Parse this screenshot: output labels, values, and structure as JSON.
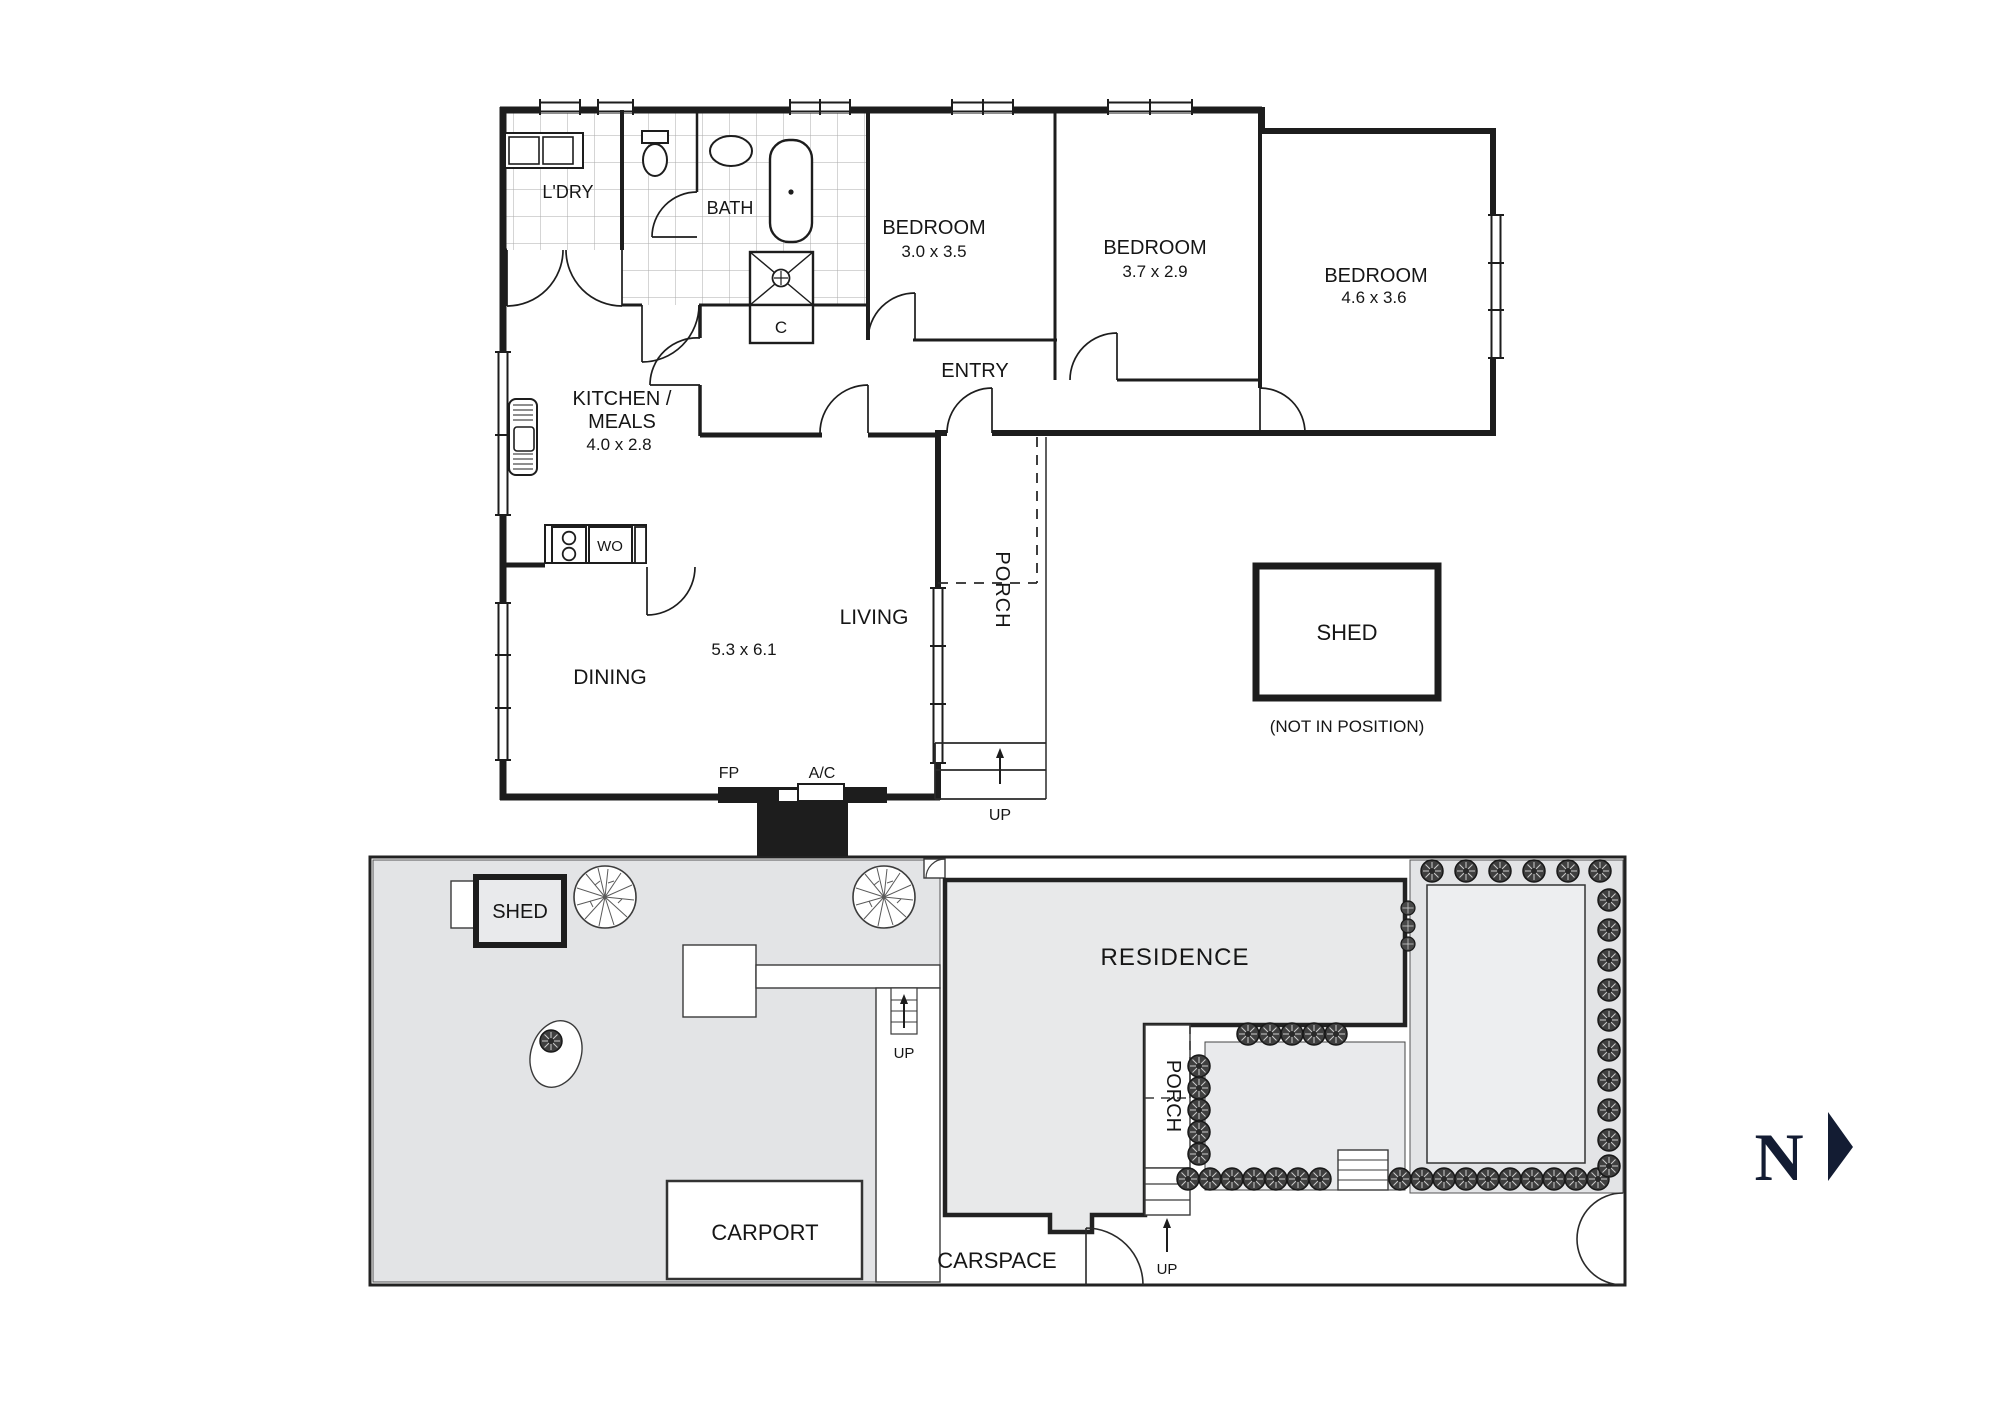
{
  "floor_plan": {
    "rooms": {
      "laundry": {
        "label": "L'DRY"
      },
      "bath": {
        "label": "BATH"
      },
      "bedroom1": {
        "label": "BEDROOM",
        "dims": "3.0 x 3.5"
      },
      "bedroom2": {
        "label": "BEDROOM",
        "dims": "3.7 x 2.9"
      },
      "bedroom3": {
        "label": "BEDROOM",
        "dims": "4.6 x 3.6"
      },
      "entry": {
        "label": "ENTRY"
      },
      "kitchen": {
        "label_line1": "KITCHEN /",
        "label_line2": "MEALS",
        "dims": "4.0 x 2.8"
      },
      "living": {
        "label": "LIVING",
        "dims": "5.3 x 6.1"
      },
      "dining": {
        "label": "DINING"
      },
      "porch": {
        "label": "PORCH"
      },
      "closet": {
        "label": "C"
      }
    },
    "fixtures": {
      "wall_oven": "WO",
      "fireplace": "FP",
      "air_conditioner": "A/C",
      "up": "UP"
    },
    "shed": {
      "label": "SHED",
      "note": "(NOT IN POSITION)"
    }
  },
  "site_plan": {
    "residence_label": "RESIDENCE",
    "porch_label": "PORCH",
    "carport_label": "CARPORT",
    "carspace_label": "CARSPACE",
    "shed_label": "SHED",
    "up_label": "UP"
  },
  "compass": {
    "north_label": "N"
  },
  "colors": {
    "wall": "#1d1d1d",
    "yard_fill": "#e3e4e6",
    "residence_fill": "#e8e9ea",
    "garden_fill": "#e9eaec",
    "north": "#131c33"
  }
}
